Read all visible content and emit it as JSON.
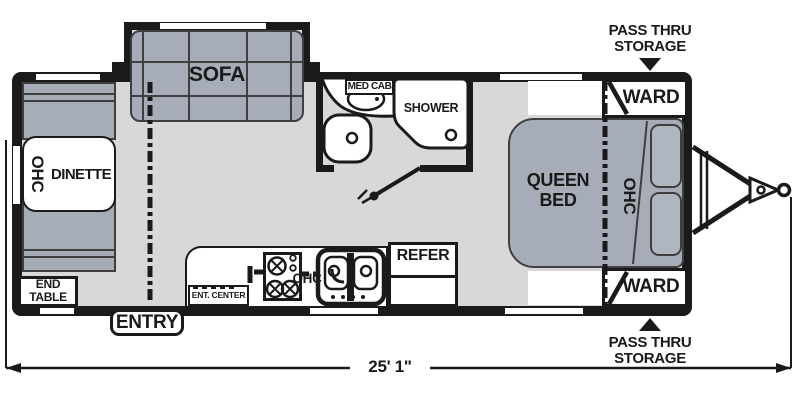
{
  "floorplan": {
    "dimension_label": "25' 1\"",
    "sofa_label": "SOFA",
    "dinette_ohc_label": "OHC",
    "dinette_label": "DINETTE",
    "end_table_line1": "END",
    "end_table_line2": "TABLE",
    "entry_label": "ENTRY",
    "ent_center_label": "ENT. CENTER",
    "kitchen_ohc_label": "OHC",
    "refer_label": "REFER",
    "med_cab_label": "MED CAB",
    "shower_label": "SHOWER",
    "queen_bed_line1": "QUEEN",
    "queen_bed_line2": "BED",
    "bed_ohc_label": "OHC",
    "ward_top_label": "WARD",
    "ward_bottom_label": "WARD",
    "pass_thru_top_line1": "PASS THRU",
    "pass_thru_top_line2": "STORAGE",
    "pass_thru_bottom_line1": "PASS THRU",
    "pass_thru_bottom_line2": "STORAGE",
    "colors": {
      "wall": "#1a1a1a",
      "floor": "#d8d8d8",
      "furniture": "#a7adb8",
      "furniture_outline": "#3f3f3f",
      "fixture_fill": "#ffffff"
    }
  }
}
